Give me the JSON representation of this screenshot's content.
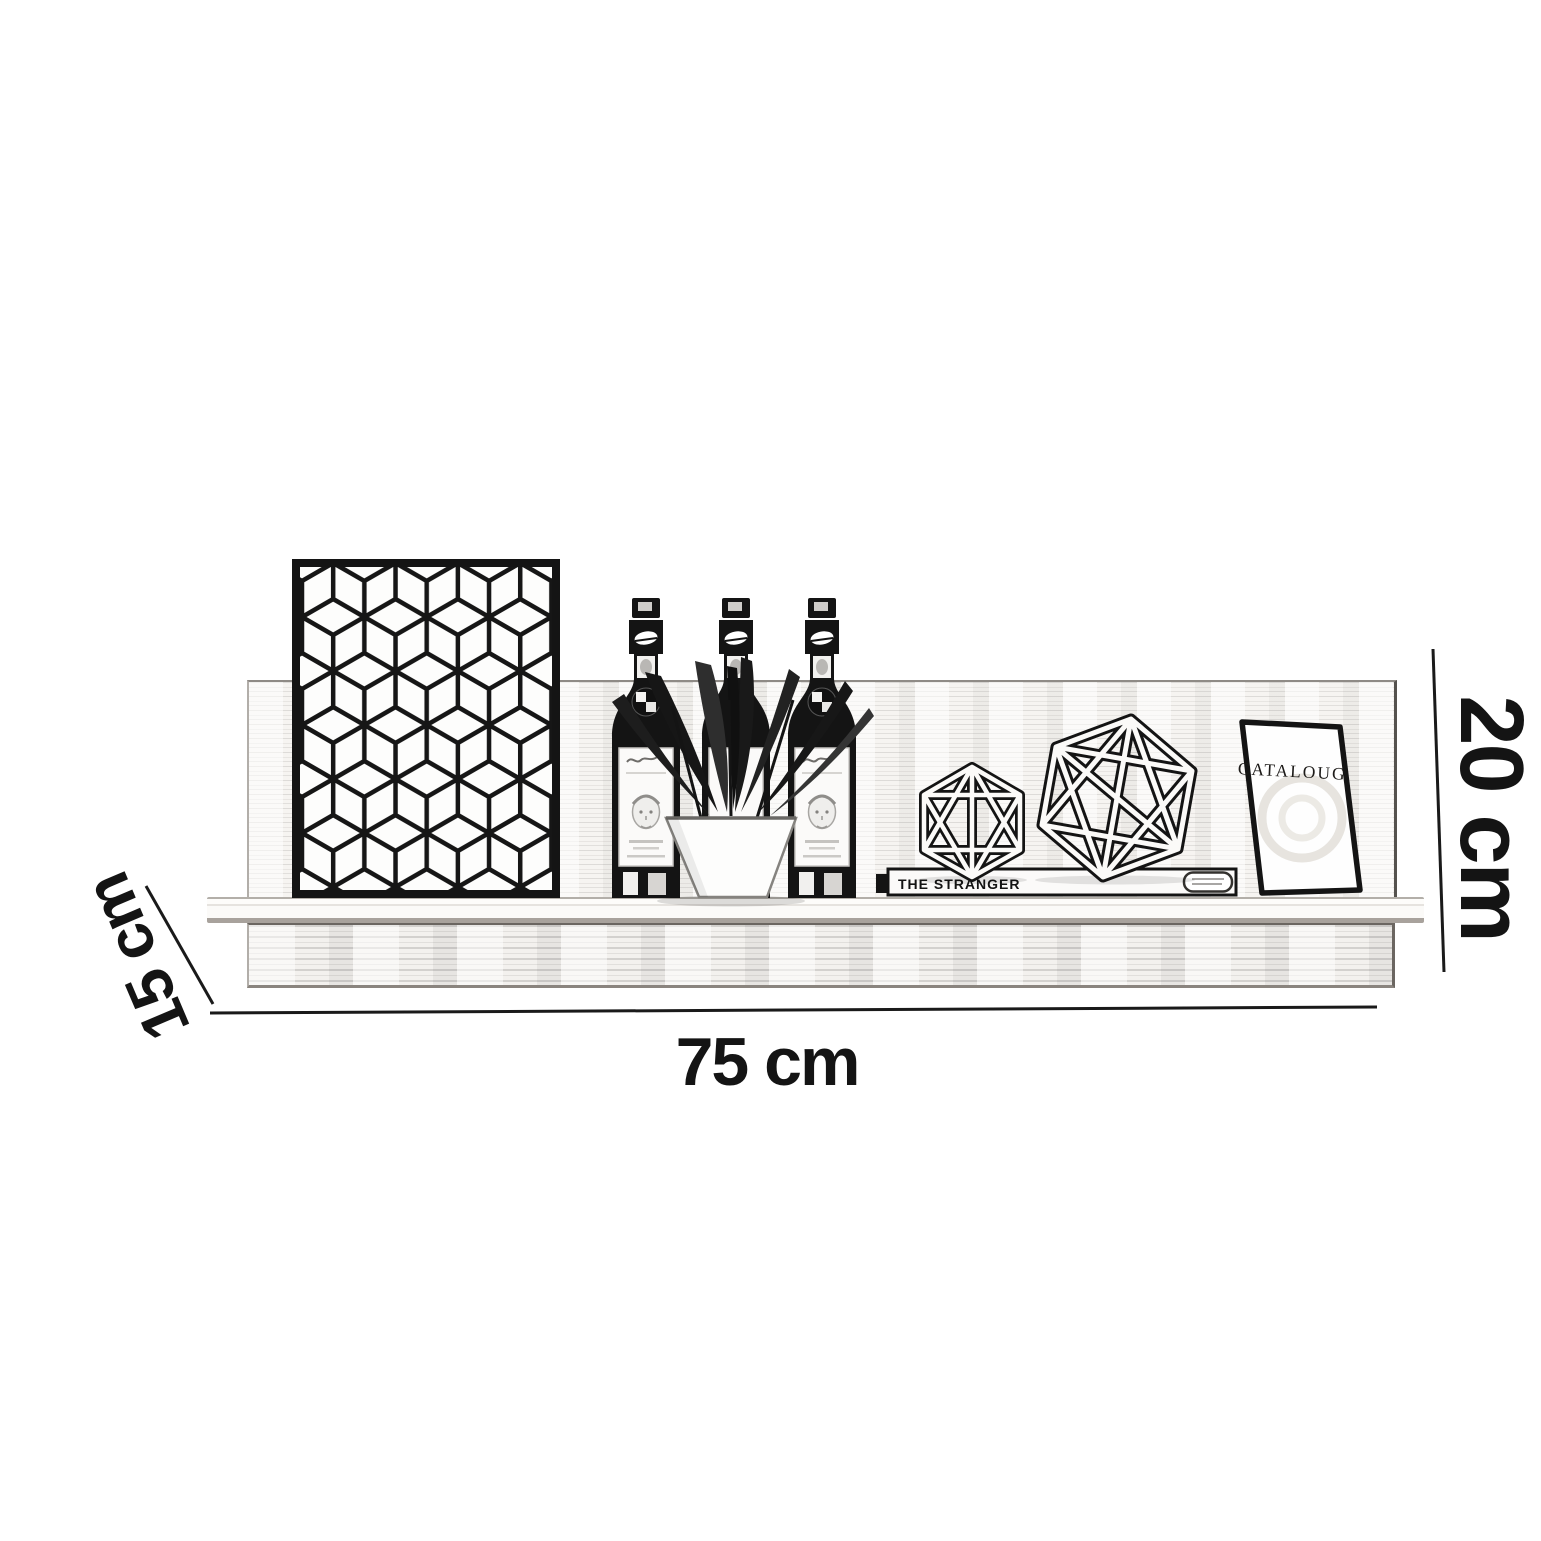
{
  "diagram": {
    "kind": "furniture-dimension-sketch",
    "colors": {
      "ink": "#141414",
      "wood_tint": "#f6f4f1",
      "paper": "#ffffff"
    }
  },
  "dimensions": {
    "width": {
      "label": "75 cm"
    },
    "height": {
      "label": "20 cm"
    },
    "depth": {
      "label": "15 cm"
    }
  },
  "decor": {
    "catalog_title": "CATALOUG",
    "book_spine_title": "THE STRANGER",
    "items": [
      "cube-pattern-art-panel",
      "bottle",
      "bottle",
      "bottle",
      "potted-plant",
      "flat-book",
      "wireframe-polyhedron-small",
      "wireframe-polyhedron-large",
      "catalog-book"
    ]
  }
}
